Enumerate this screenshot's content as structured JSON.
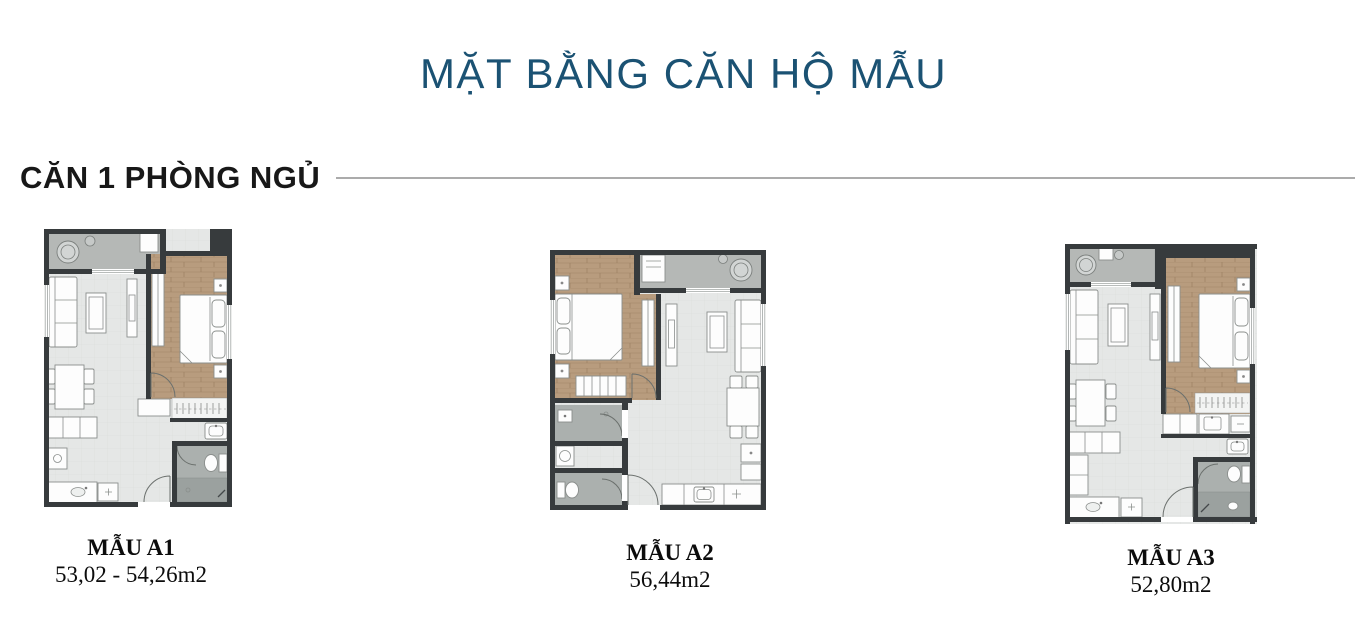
{
  "page": {
    "title": "MẶT BẰNG CĂN HỘ MẪU"
  },
  "section": {
    "heading": "CĂN 1 PHÒNG NGỦ"
  },
  "plans": [
    {
      "id": "A1",
      "name": "MẪU A1",
      "area": "53,02 - 54,26m2"
    },
    {
      "id": "A2",
      "name": "MẪU A2",
      "area": "56,44m2"
    },
    {
      "id": "A3",
      "name": "MẪU A3",
      "area": "52,80m2"
    }
  ],
  "colors": {
    "title": "#1b5273",
    "heading": "#181818",
    "divider": "#ababab",
    "label": "#0c0c0c",
    "wall": "#373b3d",
    "wood_floor": "#b89c7e",
    "balcony_floor": "#b5b8b6",
    "living_floor": "#e5e7e6",
    "bath_floor": "#abb0ae"
  }
}
